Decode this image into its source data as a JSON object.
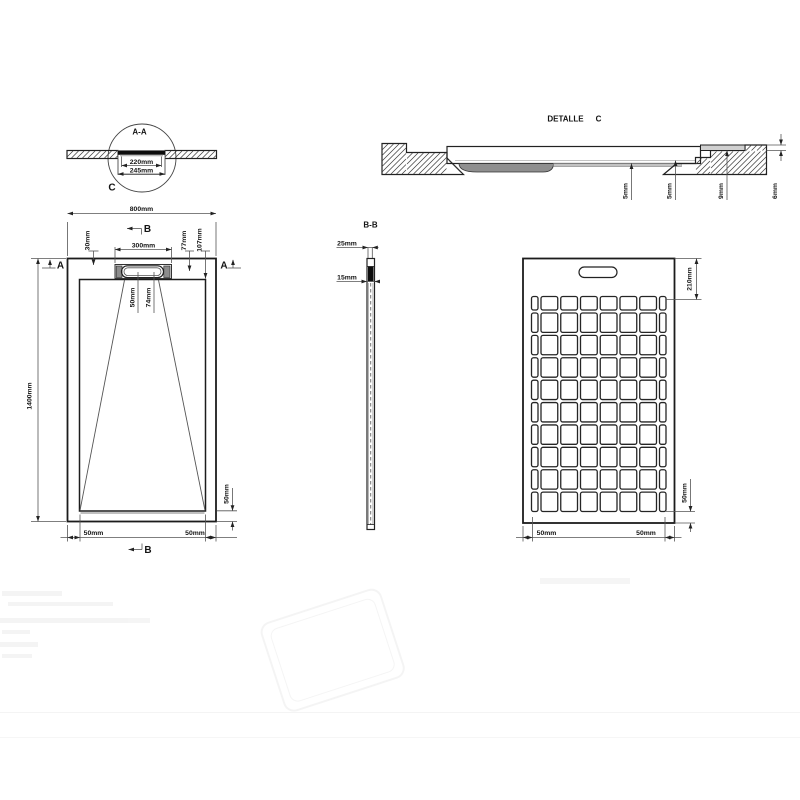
{
  "detail_aa": {
    "title": "A-A",
    "dim_inner": "220mm",
    "dim_outer": "245mm",
    "callout_letter": "C"
  },
  "detail_c": {
    "title_word": "DETALLE",
    "title_letter": "C",
    "dim_1": "5mm",
    "dim_2": "5mm",
    "dim_3": "9mm",
    "dim_4": "6mm"
  },
  "plan_view": {
    "overall_width": "800mm",
    "overall_length": "1400mm",
    "top_offset": "30mm",
    "drain_recess_width": "300mm",
    "offset_77": "77mm",
    "offset_107": "107mm",
    "drain_dim_50": "50mm",
    "drain_dim_74": "74mm",
    "bottom_left_margin": "50mm",
    "bottom_right_margin": "50mm",
    "side_bottom_margin": "50mm",
    "section_letter_a": "A",
    "section_letter_b": "B"
  },
  "section_bb": {
    "title": "B-B",
    "dim_top": "25mm",
    "dim_bottom": "15mm"
  },
  "bottom_view": {
    "top_margin": "210mm",
    "bottom_left_margin": "50mm",
    "bottom_right_margin": "50mm",
    "side_bottom_margin": "50mm",
    "grid": {
      "rows": 10,
      "cols": 8
    }
  },
  "colors": {
    "tray_fill": "#d0d0d0",
    "line": "#1f1f1f",
    "dim_line": "#555555",
    "drain_black": "#0d0d0d"
  }
}
